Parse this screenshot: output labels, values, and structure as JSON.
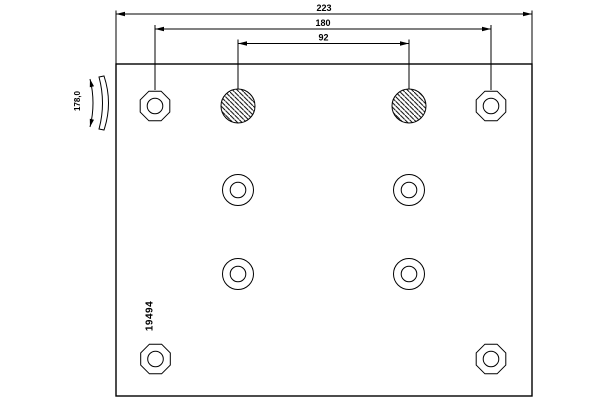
{
  "drawing": {
    "type": "technical-drawing",
    "subject": "brake lining plate with rivet holes",
    "part_number": "19494",
    "dimensions": {
      "total_length": "223",
      "outer_hole_spacing": "180",
      "inner_hole_spacing": "92",
      "lining_width": "178,0"
    },
    "holes": {
      "ring_hole_count": 8,
      "hatched_hole_count": 2
    },
    "colors": {
      "line": "#000000",
      "background": "#ffffff"
    }
  }
}
